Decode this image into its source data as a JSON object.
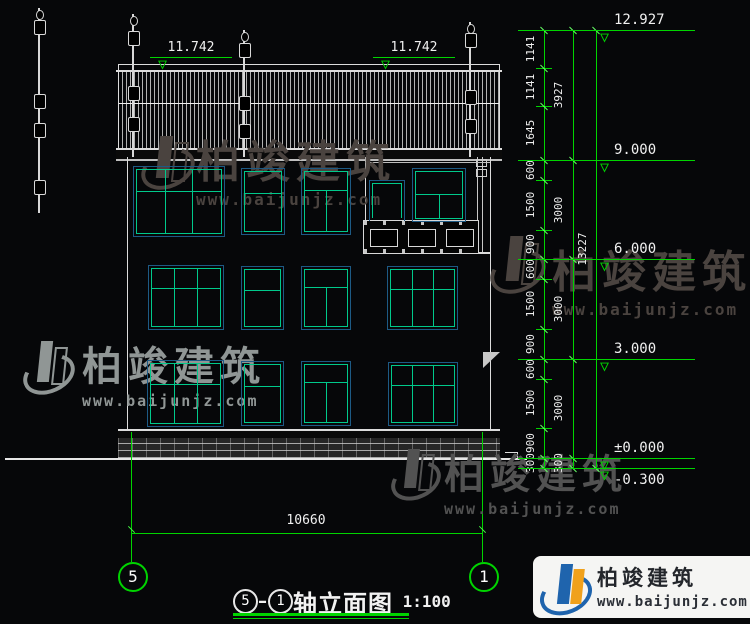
{
  "drawing": {
    "title": "轴立面图",
    "scale": "1:100",
    "axis_from": "5",
    "axis_to": "1"
  },
  "watermark": {
    "name": "柏竣建筑",
    "url": "www.baijunjz.com"
  },
  "dimensions": {
    "top_elevations": [
      "11.742",
      "11.742"
    ],
    "bottom_width": "10660",
    "right": {
      "col1": [
        "1141",
        "1141",
        "1645",
        "600",
        "1500",
        "900",
        "600",
        "1500",
        "900",
        "600",
        "1500",
        "900",
        "300"
      ],
      "col2": [
        "3927",
        "3000",
        "3000",
        "3000",
        "300"
      ],
      "col3": [
        "13227"
      ],
      "total_mm": 13227,
      "elevations": [
        {
          "label": "12.927",
          "mm": 0
        },
        {
          "label": "9.000",
          "mm": 3927
        },
        {
          "label": "6.000",
          "mm": 6927
        },
        {
          "label": "3.000",
          "mm": 9927
        },
        {
          "label": "±0.000",
          "mm": 12927
        },
        {
          "label": "-0.300",
          "mm": 13227
        }
      ]
    }
  },
  "building": {
    "windows": [
      {
        "x": 135,
        "y": 168,
        "w": 88,
        "h": 67,
        "type": "w3",
        "t": 0.34
      },
      {
        "x": 243,
        "y": 170,
        "w": 40,
        "h": 63,
        "type": "w2h",
        "t": 0.36
      },
      {
        "x": 303,
        "y": 170,
        "w": 46,
        "h": 63,
        "type": "wt",
        "t": 0.3
      },
      {
        "x": 371,
        "y": 182,
        "w": 32,
        "h": 38,
        "type": "door",
        "t": 0.2
      },
      {
        "x": 414,
        "y": 170,
        "w": 50,
        "h": 50,
        "type": "wt",
        "t": 0.48
      },
      {
        "x": 150,
        "y": 267,
        "w": 72,
        "h": 61,
        "type": "w3",
        "t": 0.34
      },
      {
        "x": 243,
        "y": 268,
        "w": 39,
        "h": 60,
        "type": "w2h",
        "t": 0.36
      },
      {
        "x": 303,
        "y": 268,
        "w": 46,
        "h": 60,
        "type": "wt",
        "t": 0.3
      },
      {
        "x": 389,
        "y": 268,
        "w": 67,
        "h": 60,
        "type": "w3",
        "t": 0.34
      },
      {
        "x": 149,
        "y": 362,
        "w": 73,
        "h": 63,
        "type": "w3",
        "t": 0.34
      },
      {
        "x": 243,
        "y": 363,
        "w": 39,
        "h": 61,
        "type": "w2h",
        "t": 0.36
      },
      {
        "x": 303,
        "y": 363,
        "w": 46,
        "h": 61,
        "type": "wt",
        "t": 0.3
      },
      {
        "x": 390,
        "y": 364,
        "w": 66,
        "h": 60,
        "type": "w3",
        "t": 0.34
      }
    ],
    "finials": [
      {
        "x": 39,
        "y": 8,
        "h": 205,
        "o": [
          0.06,
          0.42,
          0.56,
          0.84
        ]
      },
      {
        "x": 133,
        "y": 14,
        "h": 143,
        "o": [
          0.12,
          0.5,
          0.72
        ]
      },
      {
        "x": 244,
        "y": 30,
        "h": 127,
        "o": [
          0.1,
          0.52,
          0.74
        ]
      },
      {
        "x": 470,
        "y": 22,
        "h": 135,
        "o": [
          0.08,
          0.5,
          0.72
        ]
      }
    ]
  },
  "colors": {
    "dim_green": "#00d400",
    "line_white": "#dcdcdc",
    "window_frame": "#1d5a85",
    "window_mullion": "#00c98b",
    "wm_dark": "#4a433f",
    "wm_light": "#909695",
    "wm_mid": "#525252",
    "logo_blue": "#1f64ad",
    "logo_orange": "#f0a11c"
  }
}
